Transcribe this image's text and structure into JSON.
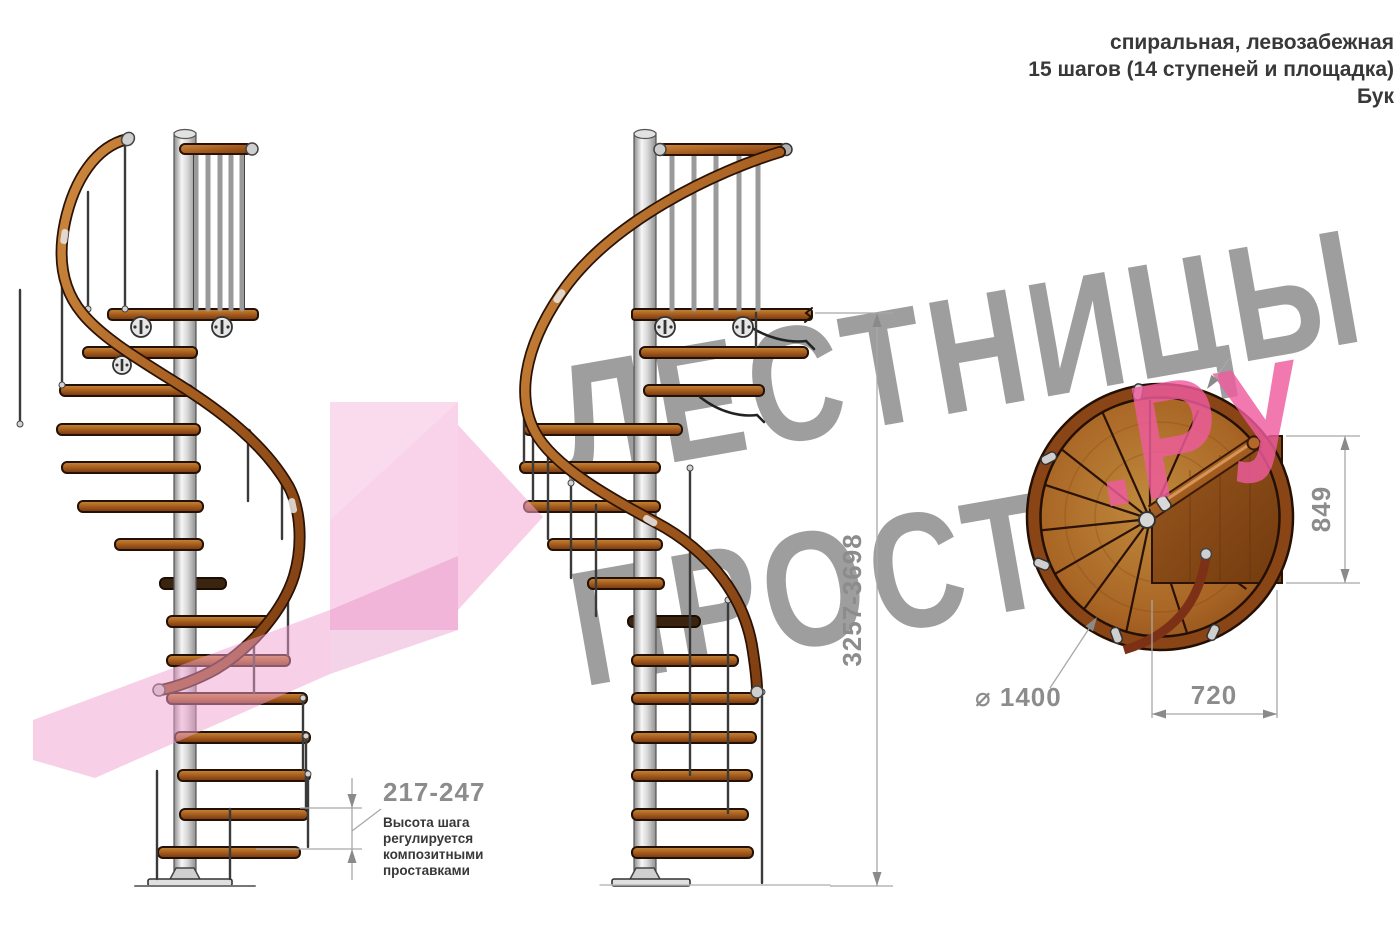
{
  "header": {
    "line1": "спиральная, левозабежная",
    "line2": "15 шагов (14 ступеней и площадка)",
    "line3": "Бук"
  },
  "watermark": {
    "word1": "ЛЕСТНИЦЫ",
    "word2": "ПРОСТО",
    "word2_suffix": ".РУ"
  },
  "annotations": {
    "step_height": {
      "value": "217-247",
      "note1": "Высота шага",
      "note2": "регулируется",
      "note3": "композитными",
      "note4": "проставками"
    },
    "total_height": {
      "value": "3257-3698"
    },
    "landing_depth": {
      "value": "849"
    },
    "landing_width": {
      "value": "720"
    },
    "diameter": {
      "value": "⌀ 1400"
    }
  },
  "colors": {
    "wood": "#a86128",
    "wood_dark": "#6f3710",
    "rail": "#b4672a",
    "pole": "#d8d8d8",
    "watermark_gray": "#9e9e9e",
    "watermark_pink": "#ef5c9e",
    "pink_arrow": "#f3a8d4",
    "dimension": "#8c8c8c"
  }
}
